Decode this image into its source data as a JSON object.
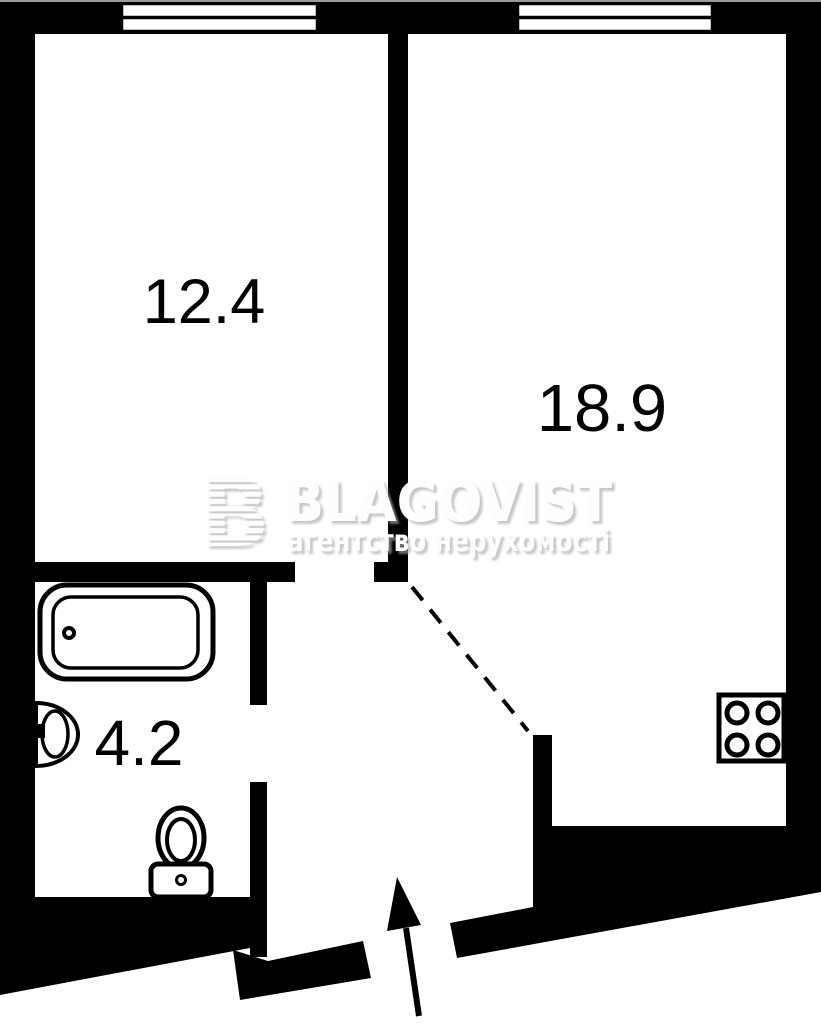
{
  "plan_title": "one-room apartment floor plan",
  "watermark": {
    "logo_letter": "B",
    "brand": "BLAGOVIST",
    "tagline": "агентство нерухомості"
  },
  "rooms": [
    {
      "name": "living-room",
      "area": "12.4"
    },
    {
      "name": "bedroom-kitchen",
      "area": "18.9"
    },
    {
      "name": "bathroom",
      "area": "4.2"
    }
  ],
  "fixtures": [
    "window-icon",
    "window-icon",
    "bathtub-icon",
    "sink-icon",
    "toilet-icon",
    "stove-icon",
    "door-swing-dashes",
    "entrance-arrow-icon"
  ],
  "colors": {
    "walls": "#000000",
    "background": "#ffffff",
    "watermark_fill": "#fdfdfd",
    "watermark_shadow": "#bdbdbd",
    "top_border": "#9a9a9a"
  }
}
